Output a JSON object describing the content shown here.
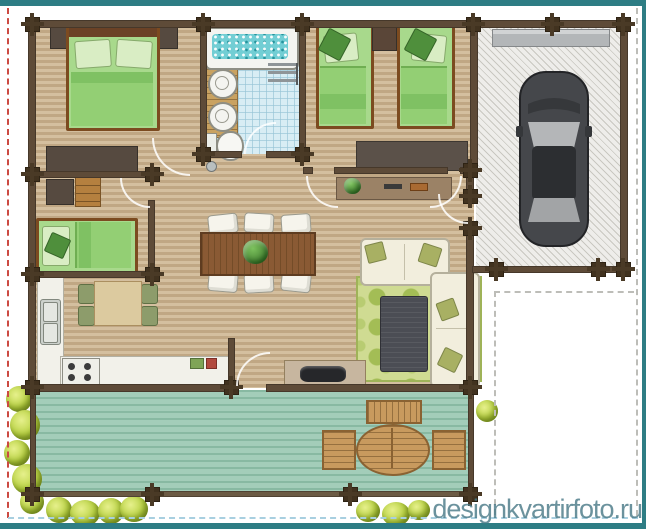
{
  "watermark": {
    "text": "designkvartirfoto.ru"
  },
  "palette": {
    "accent_teal": "#2e7d84",
    "deck_teal": "#a3cdb9",
    "wall_brown": "#5e4b38",
    "bedding_green": "#a8d98c",
    "rug_green": "#cfdb92",
    "bath_blue": "#d8edf4",
    "water_teal": "#72ced4",
    "garage_gray": "#eeedea",
    "car_body_gray": "#45474b",
    "bush_green": "#b9d243",
    "boundary_red": "#cc4a42",
    "boundary_blue": "#a8cfe0",
    "boundary_gray": "#bdbdb8"
  },
  "scene": {
    "type": "house-floor-plan-top-view",
    "rooms": [
      "master-bedroom",
      "bathroom",
      "twin-bedroom",
      "nursery",
      "kitchen",
      "dining-area",
      "living-room",
      "garage",
      "terrace"
    ],
    "objects": [
      "double-bed",
      "nightstands",
      "dresser",
      "jacuzzi-tub",
      "double-sink-vanity",
      "toilet",
      "towel-rack",
      "twin-bed",
      "twin-bed",
      "single-bed",
      "desk",
      "drawer-chest",
      "kitchen-counter",
      "kitchen-sink",
      "stove",
      "kitchen-table",
      "kitchen-chairs",
      "dining-table",
      "dining-chairs",
      "table-plant",
      "sideboard",
      "corner-sofa",
      "polka-dot-rug",
      "coffee-table",
      "tv-console",
      "tv",
      "car",
      "garage-shelf",
      "deck-bench",
      "oval-deck-table",
      "deck-chairs",
      "bushes"
    ]
  }
}
